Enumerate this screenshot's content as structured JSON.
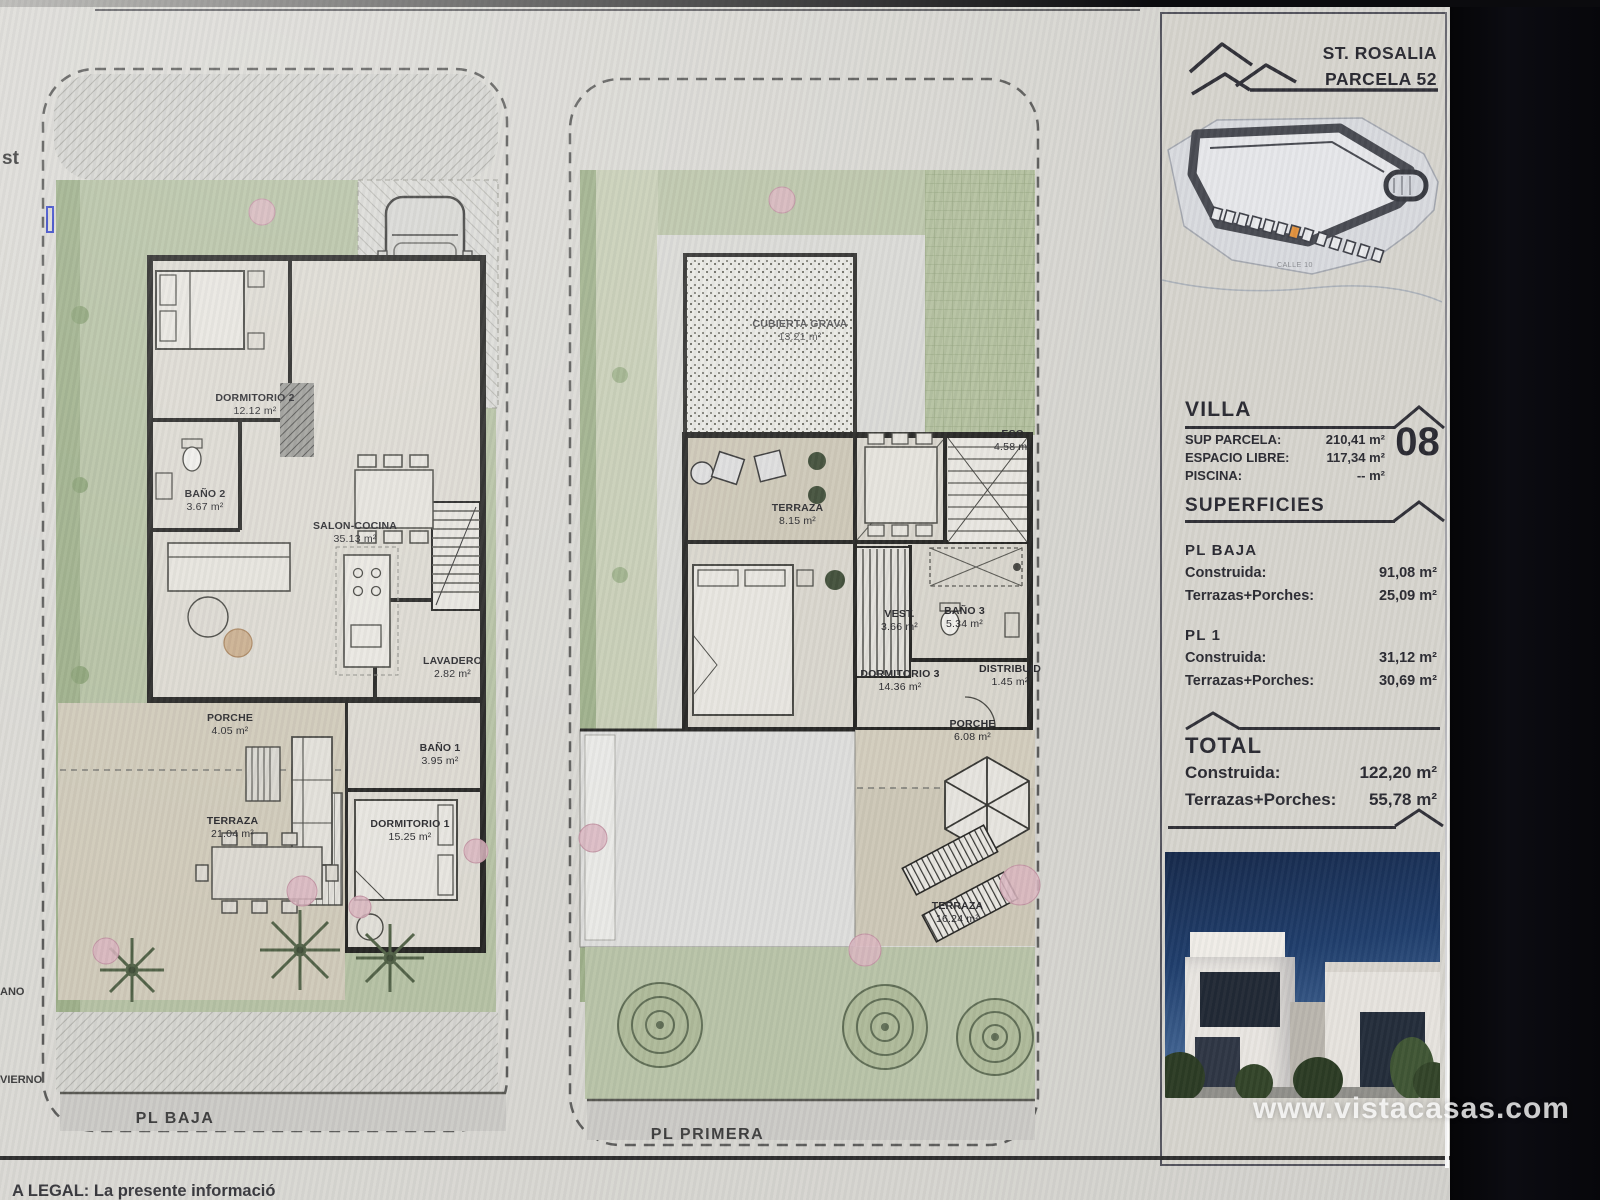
{
  "page": {
    "watermark": "www.vistacasas.com",
    "legal_notice": "A LEGAL: La presente informació",
    "edge_fragments": {
      "left_top": "st",
      "left_middle": "ANO",
      "left_bottom": "VIERNO"
    }
  },
  "header": {
    "project": "ST. ROSALIA",
    "parcel": "PARCELA 52"
  },
  "site_plan": {
    "street_label": "CALLE 10"
  },
  "villa": {
    "heading": "VILLA",
    "number": "08",
    "specs": [
      {
        "label": "SUP PARCELA:",
        "value": "210,41 m²"
      },
      {
        "label": "ESPACIO LIBRE:",
        "value": "117,34 m²"
      },
      {
        "label": "PISCINA:",
        "value": "--  m²"
      }
    ]
  },
  "superficies": {
    "heading": "SUPERFICIES",
    "blocks": [
      {
        "title": "PL BAJA",
        "rows": [
          {
            "label": "Construida:",
            "value": "91,08 m²"
          },
          {
            "label": "Terrazas+Porches:",
            "value": "25,09 m²"
          }
        ]
      },
      {
        "title": "PL 1",
        "rows": [
          {
            "label": "Construida:",
            "value": "31,12 m²"
          },
          {
            "label": "Terrazas+Porches:",
            "value": "30,69 m²"
          }
        ]
      }
    ]
  },
  "total": {
    "heading": "TOTAL",
    "rows": [
      {
        "label": "Construida:",
        "value": "122,20 m²"
      },
      {
        "label": "Terrazas+Porches:",
        "value": "55,78 m²"
      }
    ]
  },
  "plans": {
    "baja": {
      "footer_label": "PL BAJA",
      "rooms": [
        {
          "name": "DORMITORIO 2",
          "area": "12.12 m²"
        },
        {
          "name": "BAÑO 2",
          "area": "3.67 m²"
        },
        {
          "name": "SALON-COCINA",
          "area": "35.13 m²"
        },
        {
          "name": "LAVADERO",
          "area": "2.82 m²"
        },
        {
          "name": "PORCHE",
          "area": "4.05 m²"
        },
        {
          "name": "TERRAZA",
          "area": "21.04 m²"
        },
        {
          "name": "BAÑO 1",
          "area": "3.95 m²"
        },
        {
          "name": "DORMITORIO 1",
          "area": "15.25 m²"
        }
      ]
    },
    "primera": {
      "footer_label": "PL PRIMERA",
      "rooms": [
        {
          "name": "CUBIERTA GRAVA",
          "area": "13.21 m²"
        },
        {
          "name": "ESC",
          "area": "4.58 m²"
        },
        {
          "name": "TERRAZA",
          "area": "8.15 m²"
        },
        {
          "name": "VEST.",
          "area": "3.66 m²"
        },
        {
          "name": "BAÑO 3",
          "area": "5.34 m²"
        },
        {
          "name": "DORMITORIO 3",
          "area": "14.36 m²"
        },
        {
          "name": "DISTRIBUID",
          "area": "1.45 m²"
        },
        {
          "name": "PORCHE",
          "area": "6.08 m²"
        },
        {
          "name": "TERRAZA",
          "area": "16.24 m²"
        }
      ]
    }
  },
  "palette": {
    "paper": "#d8d7d2",
    "wall": "#222220",
    "garden_green": "#b4c0a2",
    "terrace_beige": "#cfc9b8",
    "plot_highlight": "#e2903a",
    "pink_bush": "#d9b4be",
    "watermark": "#ffffff"
  }
}
